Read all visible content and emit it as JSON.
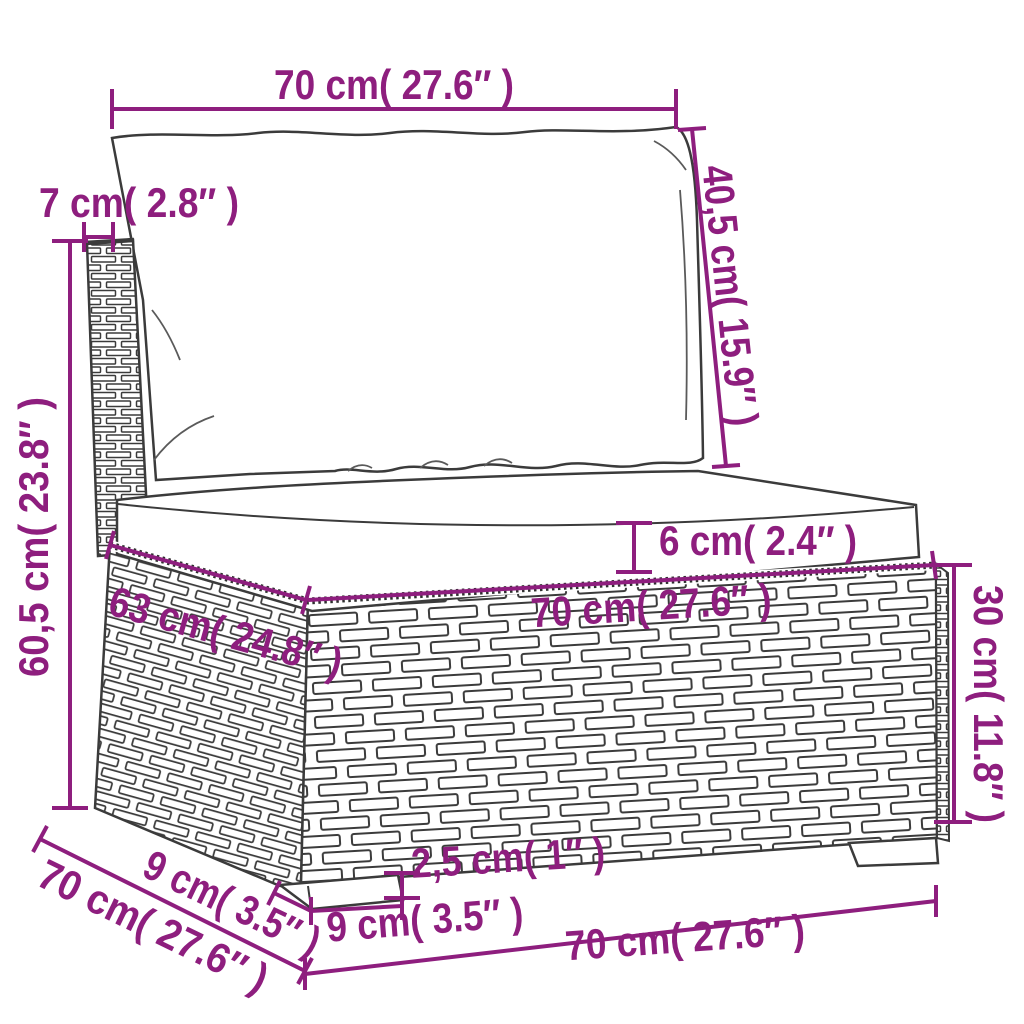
{
  "diagram": {
    "type": "furniture-dimension-diagram",
    "subject": "rattan sofa middle section with cushions",
    "colors": {
      "dimension_accent": "#8E1E7E",
      "line_art": "#3B3B3B",
      "background": "#FFFFFF"
    },
    "labels": {
      "back_width": "70 cm( 27.6″ )",
      "back_thickness": "7 cm( 2.8″ )",
      "back_cushion_height": "40,5 cm( 15.9″ )",
      "total_height": "60,5 cm( 23.8″ )",
      "seat_cushion_thickness": "6 cm( 2.4″ )",
      "seat_depth": "63 cm( 24.8″ )",
      "seat_width": "70 cm( 27.6″ )",
      "base_height": "30 cm( 11.8″ )",
      "foot_height": "2,5 cm( 1″ )",
      "foot_width": "9 cm( 3.5″ )",
      "foot_depth": "9 cm( 3.5″ )",
      "base_depth": "70 cm( 27.6″ )",
      "base_width": "70 cm( 27.6″ )"
    }
  }
}
